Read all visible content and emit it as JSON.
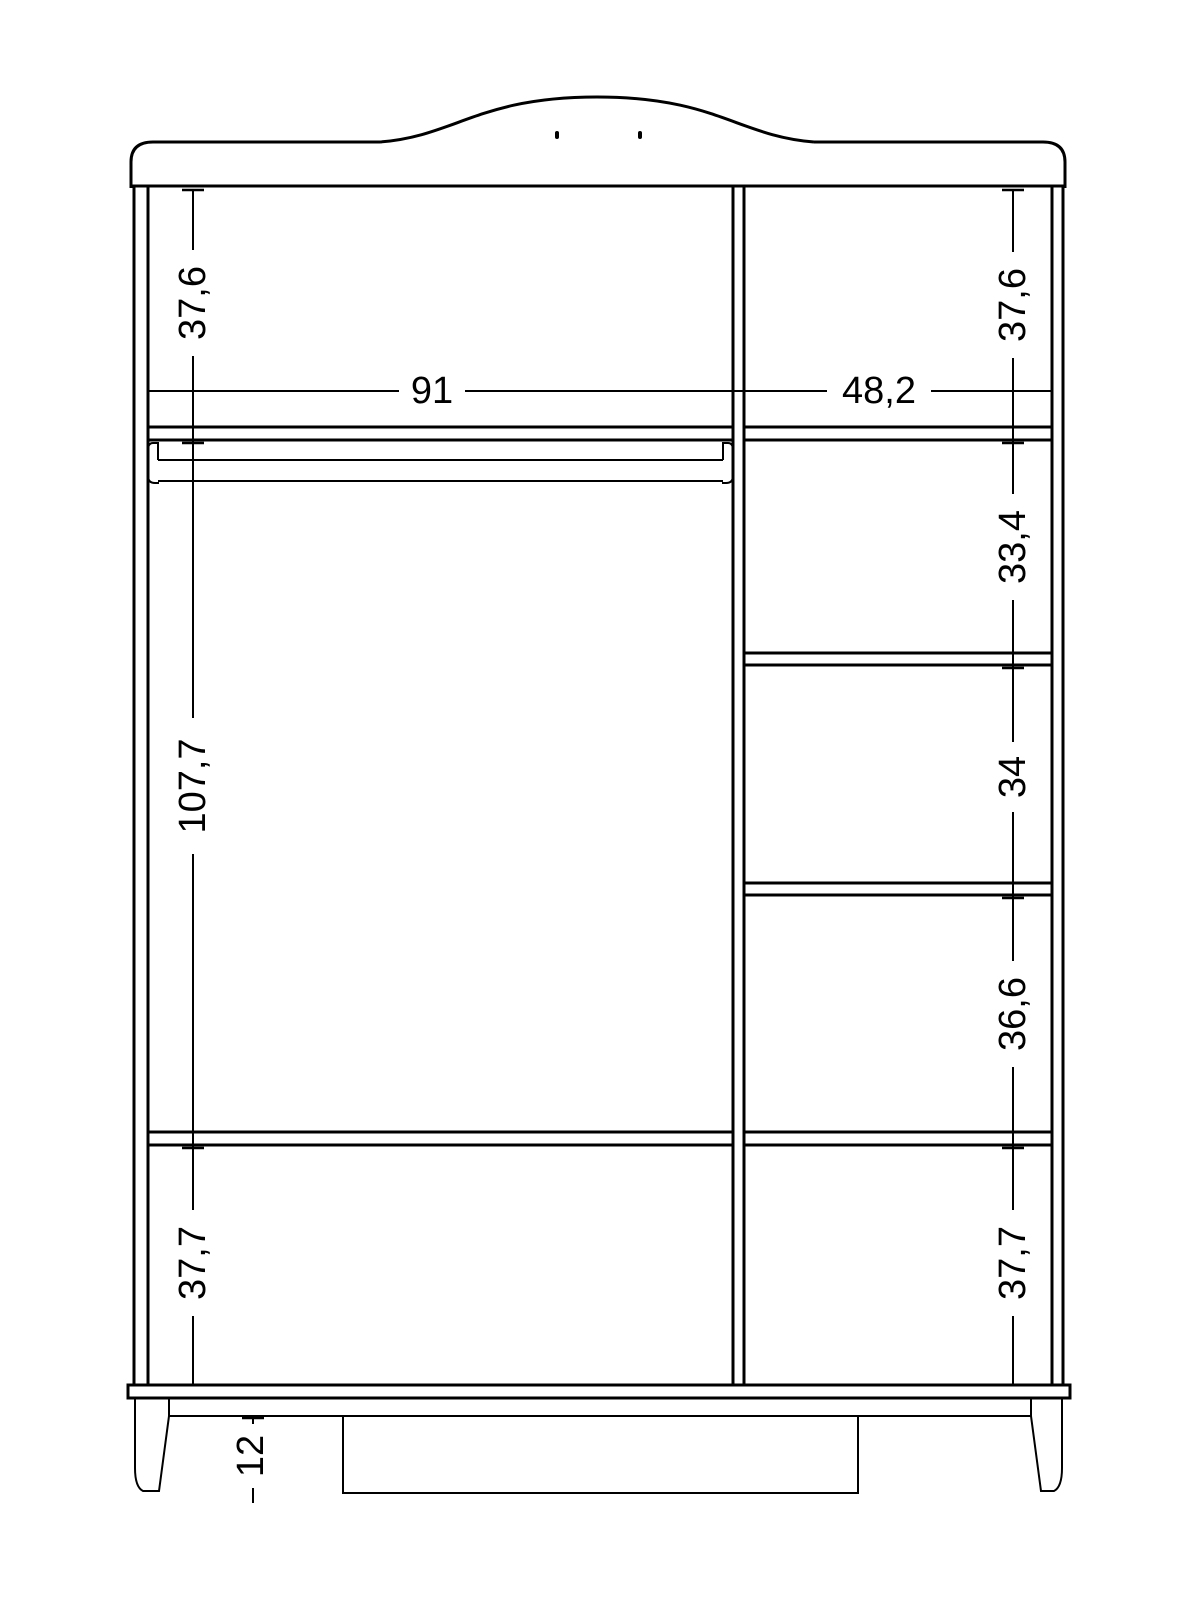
{
  "drawing": {
    "background_color": "#ffffff",
    "line_color": "#000000"
  },
  "dimensions": {
    "left_upper_height": "37,6",
    "left_section_width": "91",
    "right_section_width": "48,2",
    "right_upper_height": "37,6",
    "right_compartment_1_height": "33,4",
    "left_hanging_height": "107,7",
    "right_compartment_2_height": "34",
    "right_compartment_3_height": "36,6",
    "left_lower_height": "37,7",
    "right_lower_height": "37,7",
    "leg_height": "12"
  }
}
